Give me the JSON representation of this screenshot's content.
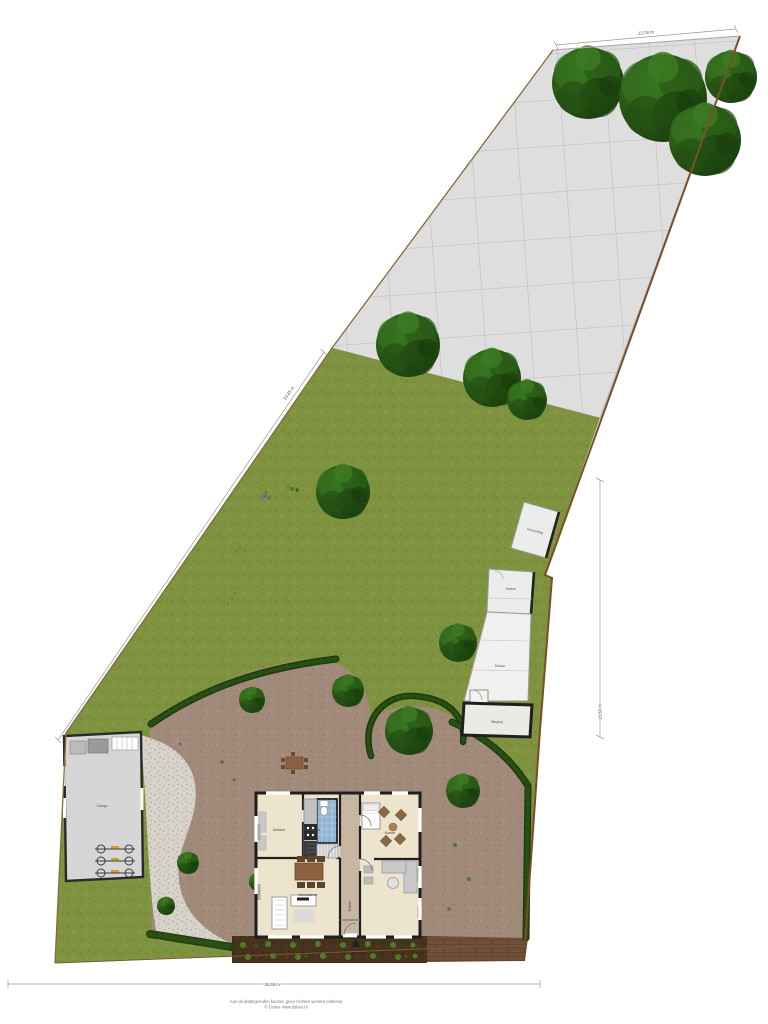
{
  "plan": {
    "type": "residential site plan with ground floor floorplan",
    "dimensions": {
      "top": "13.28 m",
      "left": "33.65 m",
      "right": "18.50 m",
      "bottom": "36.38 m"
    },
    "outbuildings": {
      "garage": "Garage",
      "wood_store": "Houtopslag",
      "shed_upper": "Schuur",
      "shed_lower": "Schuur",
      "storage": "Berging"
    },
    "rooms": {
      "kitchen": "Keuken",
      "bathroom": "Badkamer",
      "bedroom": "Kamer",
      "living": "Woonkamer",
      "hall": "Entree"
    },
    "footer": {
      "disclaimer": "Aan de plattegronden kunnen geen rechten worden ontleend",
      "copyright": "© Dziner www.dziner.nl"
    },
    "colors": {
      "grass": "#7e9240",
      "tiles": "#dedede",
      "terrace": "#a18a7a",
      "gravel": "#d7d3ca",
      "hedge": "#1d3a0e",
      "tree": "#2a5a16",
      "floor": "#ece4cd",
      "bathroom": "#8fb4d4",
      "wall": "#1f1f1f",
      "fence": "#8a6a3a"
    }
  }
}
